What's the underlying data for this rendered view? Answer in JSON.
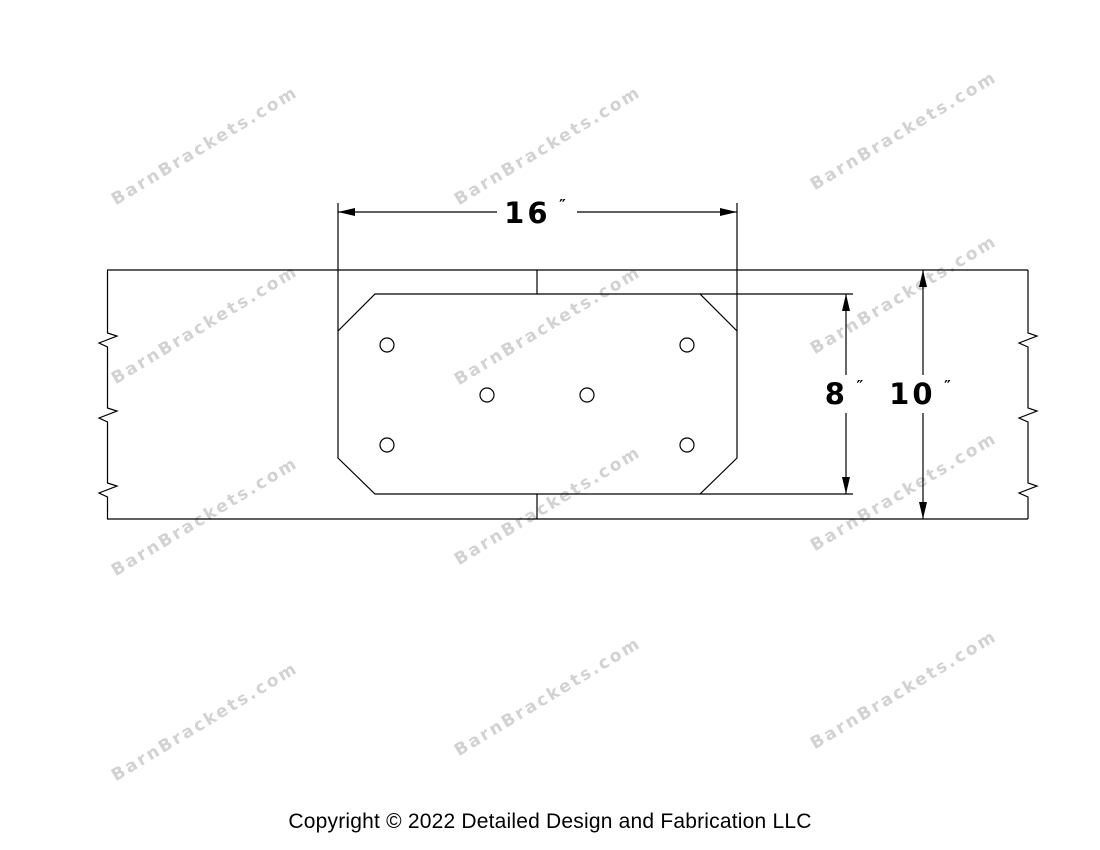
{
  "watermark": {
    "text": "BarnBrackets.com",
    "color": "#d2d2d2",
    "positions": [
      [
        205,
        146
      ],
      [
        548,
        146
      ],
      [
        904,
        131
      ],
      [
        205,
        325
      ],
      [
        548,
        326
      ],
      [
        904,
        295
      ],
      [
        205,
        517
      ],
      [
        548,
        506
      ],
      [
        904,
        492
      ],
      [
        205,
        722
      ],
      [
        548,
        697
      ],
      [
        904,
        690
      ]
    ]
  },
  "drawing": {
    "dimensions": [
      {
        "name": "bracket-width",
        "value": "16",
        "unit": "″"
      },
      {
        "name": "bracket-height",
        "value": "8",
        "unit": "″"
      },
      {
        "name": "beam-height",
        "value": "10",
        "unit": "″"
      }
    ]
  },
  "footer": {
    "copyright": "Copyright © 2022 Detailed Design and Fabrication LLC"
  }
}
